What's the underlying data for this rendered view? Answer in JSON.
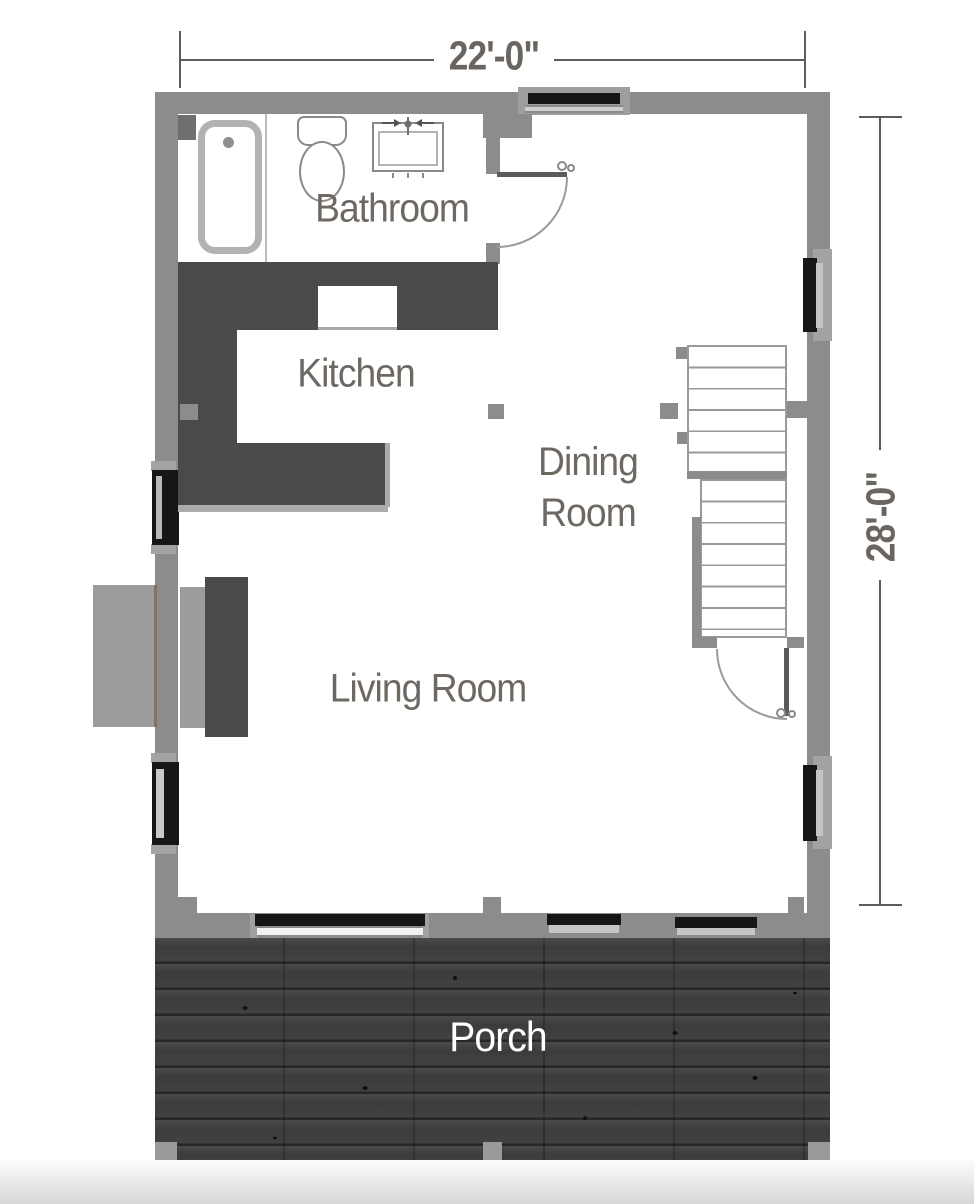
{
  "floor_plan": {
    "dimensions": {
      "width": "22'-0\"",
      "depth": "28'-0\""
    },
    "rooms": {
      "bathroom": "Bathroom",
      "kitchen": "Kitchen",
      "dining": "Dining Room",
      "living": "Living Room",
      "porch": "Porch"
    },
    "fixtures": [
      "bathtub",
      "toilet",
      "sink-vanity",
      "kitchen-counter",
      "range-cutout",
      "fireplace",
      "staircase",
      "door-swing",
      "window",
      "sliding-glass-door",
      "porch-deck",
      "porch-post",
      "column-post"
    ],
    "colors": {
      "wall": "#8c8c8c",
      "casework_dark": "#4a4a4a",
      "window_glass": "#161616",
      "label_text": "#6e6862",
      "dimension_text": "#6b6560",
      "porch_wood": "#3e3e3e"
    }
  }
}
